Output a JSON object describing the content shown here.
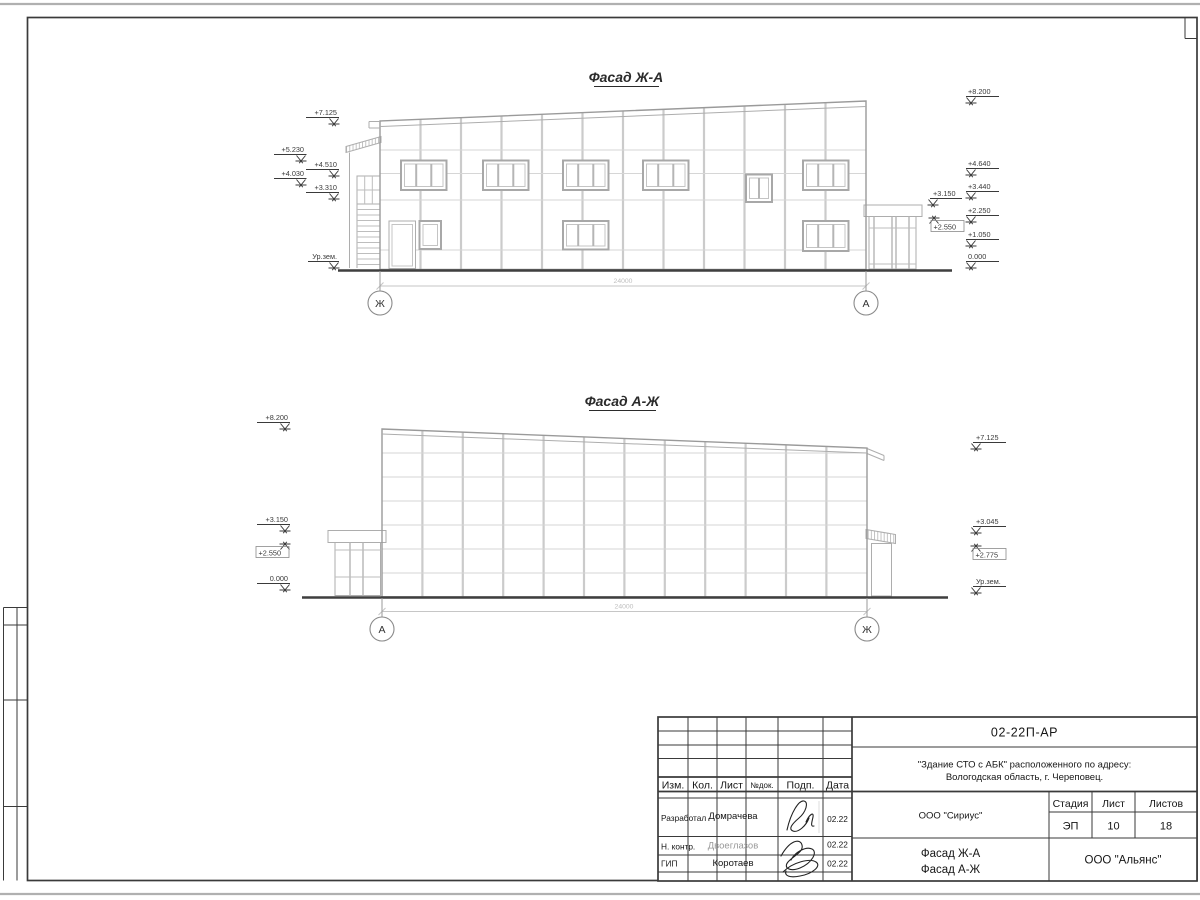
{
  "facade_top": {
    "title": "Фасад Ж-А",
    "axis_left": "Ж",
    "axis_right": "А",
    "dimension": "24000",
    "marks_left": [
      "+7.125",
      "+5.230",
      "+4.510",
      "+4.030",
      "+3.310",
      "Ур.зем."
    ],
    "marks_right": [
      "+8.200",
      "+4.640",
      "+3.440",
      "+2.250",
      "+1.050",
      "0.000"
    ],
    "marks_annex": [
      "+3.150",
      "+2.550"
    ]
  },
  "facade_bottom": {
    "title": "Фасад А-Ж",
    "axis_left": "А",
    "axis_right": "Ж",
    "dimension": "24000",
    "marks_left": [
      "+8.200",
      "+3.150",
      "+2.550",
      "0.000"
    ],
    "marks_right": [
      "+7.125",
      "+3.045",
      "+2.775",
      "Ур.зем."
    ]
  },
  "title_block": {
    "doc_number": "02-22П-АР",
    "project_address_line1": "\"Здание СТО с АБК\" расположенного по адресу:",
    "project_address_line2": "Вологодская область, г. Череповец.",
    "columns": {
      "izm": "Изм.",
      "kol": "Кол.",
      "list": "Лист",
      "doc": "№док.",
      "sign": "Подп.",
      "date": "Дата"
    },
    "signature_rows": [
      {
        "role": "Разработал",
        "name": "Домрачева",
        "date": "02.22"
      },
      {
        "role": "Н. контр.",
        "name": "Двоеглазов",
        "date": "02.22"
      },
      {
        "role": "ГИП",
        "name": "Коротаев",
        "date": "02.22"
      }
    ],
    "designer_org": "ООО \"Сириус\"",
    "stage_label": "Стадия",
    "stage": "ЭП",
    "sheet_label": "Лист",
    "sheet_number": "10",
    "sheets_label": "Листов",
    "sheets_total": "18",
    "drawing_title_line1": "Фасад Ж-А",
    "drawing_title_line2": "Фасад А-Ж",
    "contractor_org": "ООО \"Альянс\""
  }
}
